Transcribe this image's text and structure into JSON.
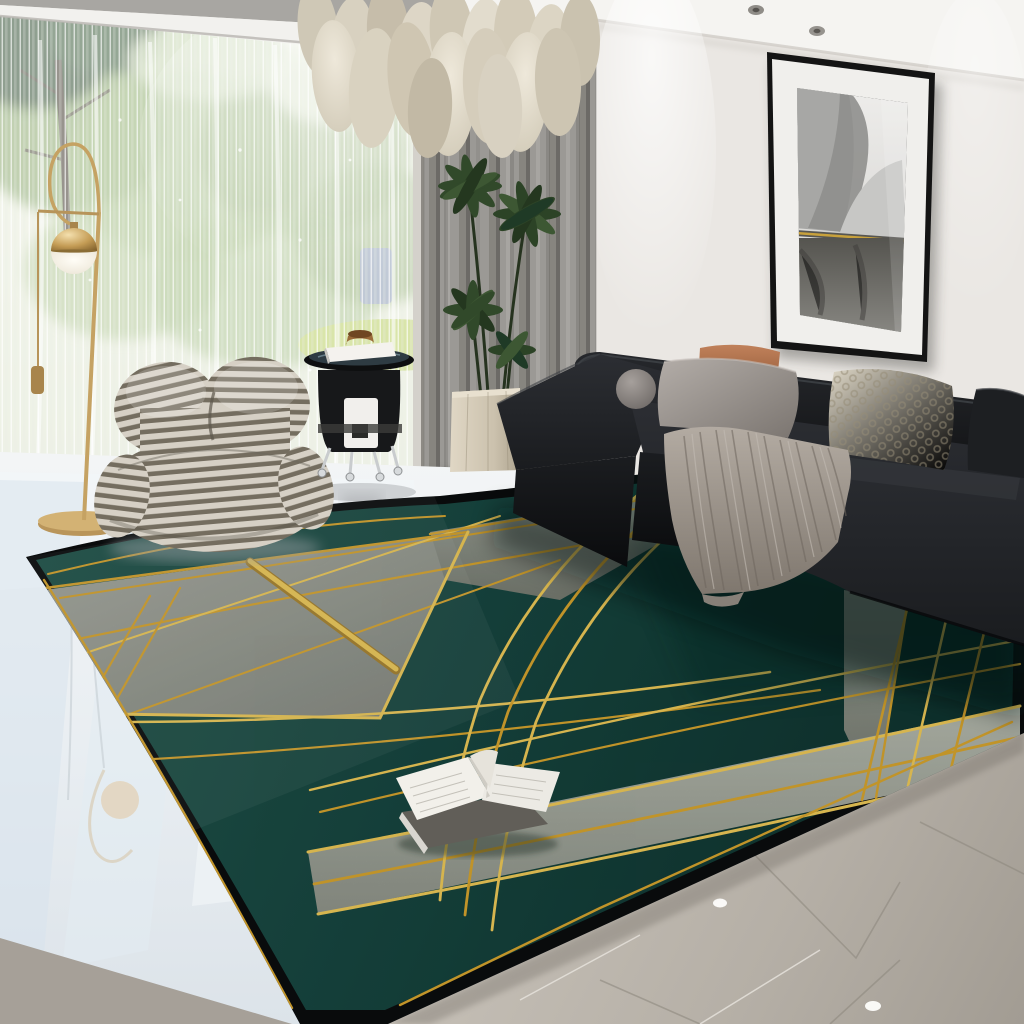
{
  "scene": {
    "type": "living-room interior photo, no visible text",
    "objects": [
      "pendant-chandelier",
      "window-with-trees",
      "sheer-curtain",
      "gray-curtain",
      "arc-floor-lamp",
      "striped-lounge-chair",
      "black-side-table",
      "potted-plant",
      "wall-art-frame",
      "black-leather-sofa",
      "throw-blanket",
      "pillows",
      "green-gold-geometric-rug",
      "open-book",
      "glossy-floor",
      "marble-floor"
    ]
  },
  "colors": {
    "wall": "#eae7e3",
    "ceiling": "#f5f4f1",
    "soffit": "#a8a6a2",
    "curtain-gray": "#8f8d89",
    "rug-green": "#1b4a42",
    "rug-green-dark": "#10322d",
    "rug-gray": "#959a90",
    "rug-gold": "#d7a52e",
    "rug-gold-bright": "#efca58",
    "rug-border": "#0b0d0e",
    "sofa-black": "#17191c",
    "pillow-terracotta": "#b0714c",
    "pillow-gray": "#a29c97",
    "pillow-cream": "#d8d1c0",
    "blanket-gray": "#9a938b",
    "chair-cream": "#d6d0c5",
    "chair-taupe": "#746d5f",
    "brass": "#b9955a",
    "plant-green": "#31492a",
    "pot-beige": "#cfc5b1",
    "floor-gloss": "#ecf0f4",
    "floor-marble": "#b7b1a8",
    "book-page": "#f2f0ea"
  }
}
